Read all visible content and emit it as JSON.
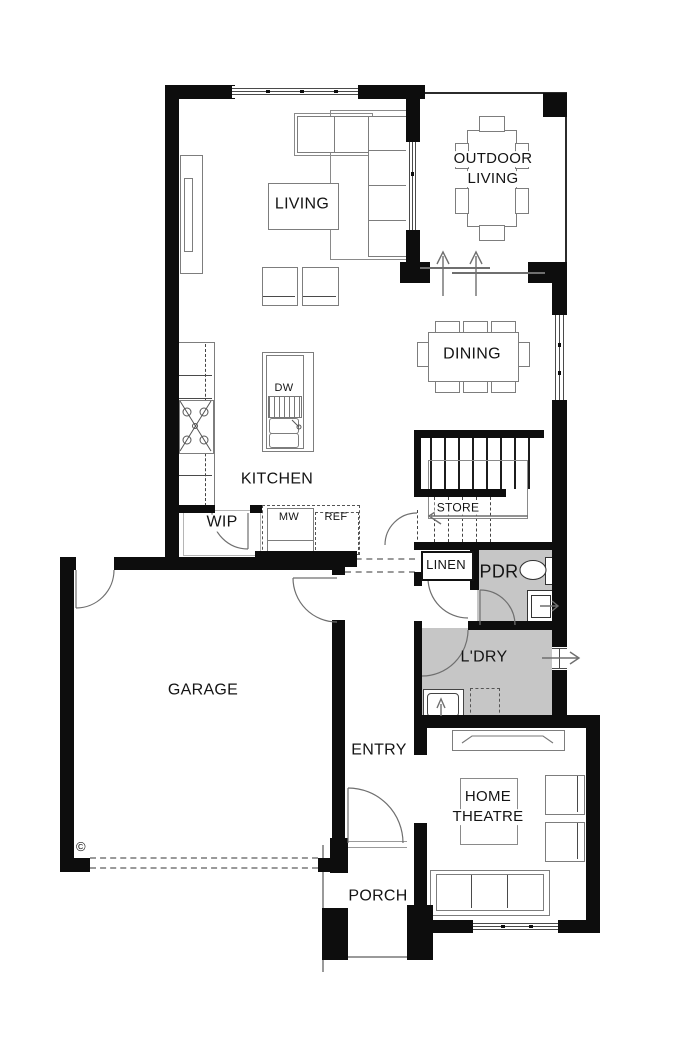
{
  "title": "Ground floor plan",
  "colors": {
    "wall": "#0d0d0d",
    "line": "#7d7d7d",
    "wet_area": "#c6c6c6",
    "background": "#ffffff"
  },
  "rooms": {
    "living": {
      "label": "LIVING"
    },
    "outdoor_living": {
      "line1": "OUTDOOR",
      "line2": "LIVING"
    },
    "dining": {
      "label": "DINING"
    },
    "kitchen": {
      "label": "KITCHEN"
    },
    "wip": {
      "label": "WIP"
    },
    "store": {
      "label": "STORE"
    },
    "linen": {
      "label": "LINEN"
    },
    "powder": {
      "label": "PDR"
    },
    "laundry": {
      "label": "L'DRY"
    },
    "garage": {
      "label": "GARAGE"
    },
    "entry": {
      "label": "ENTRY"
    },
    "home_theatre": {
      "line1": "HOME",
      "line2": "THEATRE"
    },
    "porch": {
      "label": "PORCH"
    }
  },
  "appliances": {
    "dishwasher": {
      "label": "DW"
    },
    "microwave": {
      "label": "MW"
    },
    "fridge": {
      "label": "REF"
    }
  },
  "marks": {
    "copyright": "©"
  }
}
